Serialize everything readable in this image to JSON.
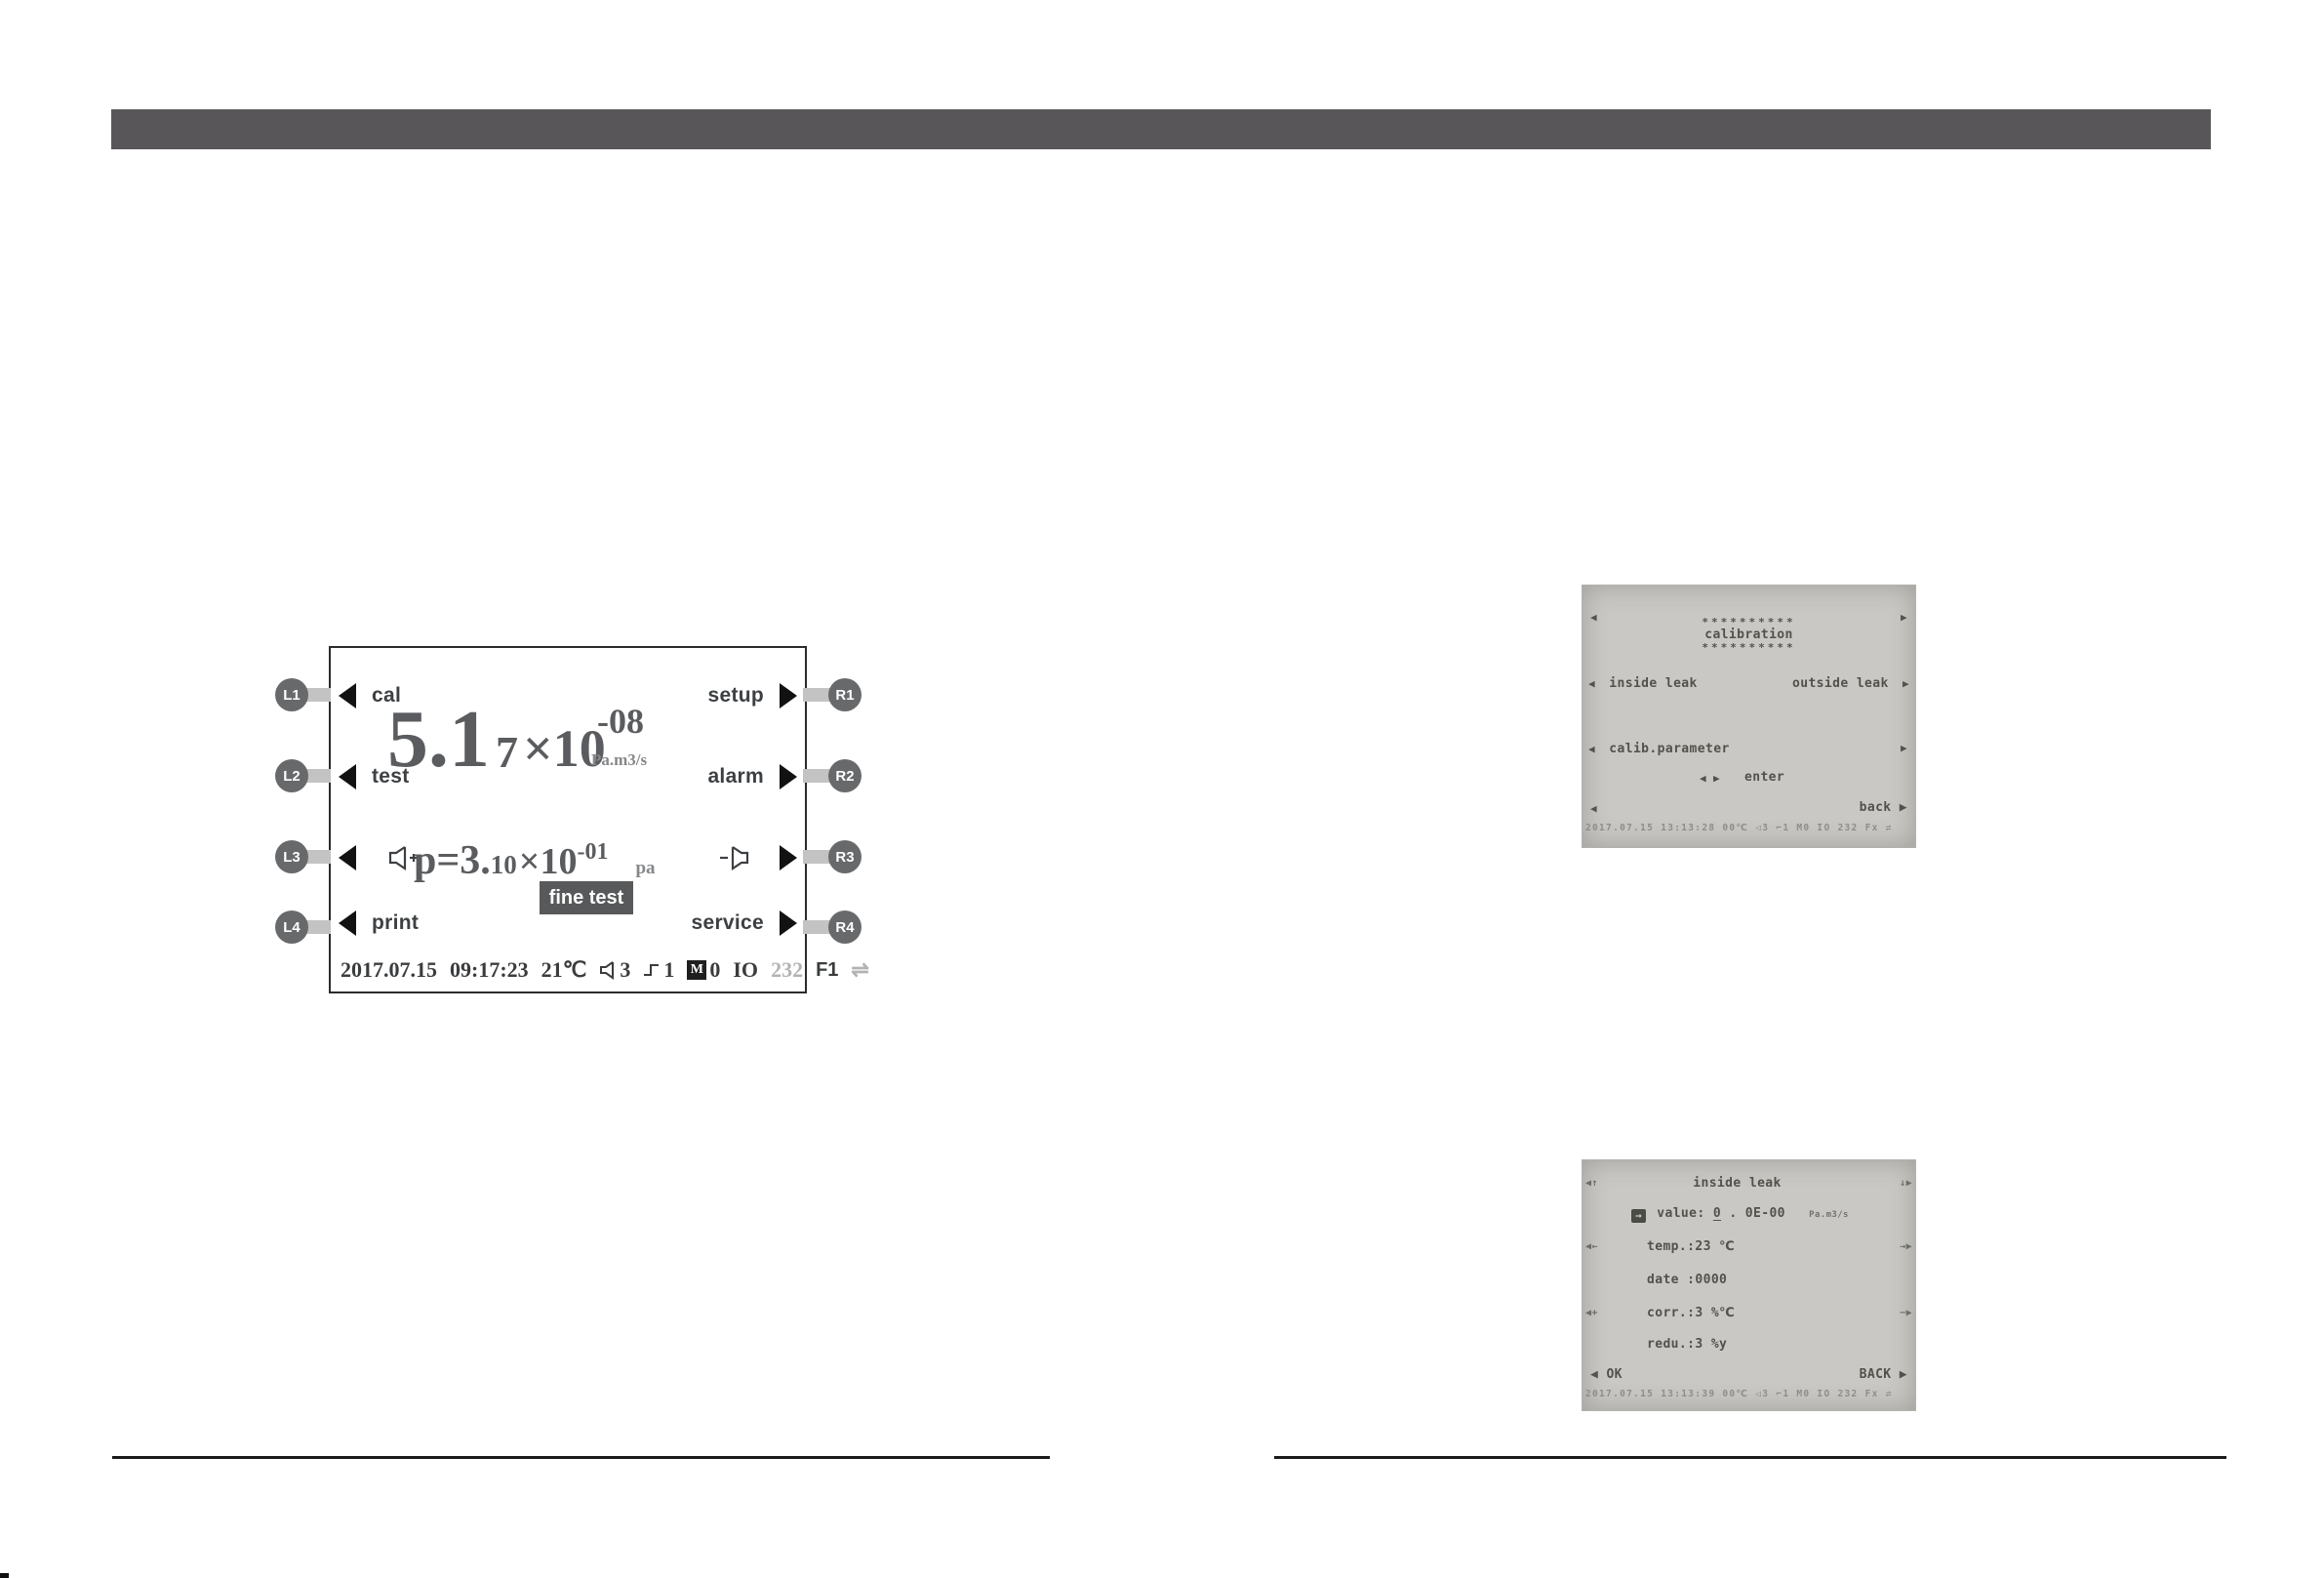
{
  "device_panel": {
    "left_buttons": [
      {
        "id": "L1",
        "label": "cal"
      },
      {
        "id": "L2",
        "label": "test"
      },
      {
        "id": "L3",
        "label": "",
        "icon": "volume-up-icon"
      },
      {
        "id": "L4",
        "label": "print"
      }
    ],
    "right_buttons": [
      {
        "id": "R1",
        "label": "setup"
      },
      {
        "id": "R2",
        "label": "alarm"
      },
      {
        "id": "R3",
        "label": "",
        "icon": "volume-down-icon"
      },
      {
        "id": "R4",
        "label": "service"
      }
    ],
    "leak_rate": {
      "mantissa": "5.1",
      "digit_small": "7",
      "times": "×10",
      "exponent": "-08",
      "unit": "Pa.m3/s"
    },
    "pressure": {
      "prefix": "p=3.",
      "digit_small": "10",
      "times": "×10",
      "exponent": "-01",
      "unit": "pa"
    },
    "mode_badge": "fine test",
    "status_bar": {
      "date": "2017.07.15",
      "time": "09:17:23",
      "temperature": "21℃",
      "volume_level": "3",
      "pulse_level": "1",
      "memory_letter": "M",
      "memory_value": "0",
      "io_label": "IO",
      "serial_label": "232",
      "function_label": "F1",
      "link_symbol": "⇌"
    }
  },
  "lcd_calibration": {
    "nav_left": "◀",
    "nav_right": "▶",
    "stars_top": "**********",
    "title": "calibration",
    "stars_bottom": "**********",
    "inside_leak_arrow": "◀",
    "inside_leak_label": "inside leak",
    "outside_leak_label": "outside leak",
    "outside_leak_arrow": "▶",
    "param_arrow": "◀",
    "param_label": "calib.parameter",
    "param_right_arrow": "▶",
    "enter_arrows": "◀ ▶",
    "enter_label": "enter",
    "back_left_arrow": "◀",
    "back_label": "back ▶",
    "status_line": "2017.07.15 13:13:28 00℃ ◁3 ⌐1 M0 IO 232 Fx ⇌"
  },
  "lcd_inside_leak": {
    "nav_top_left": "◀↑",
    "title": "inside leak",
    "nav_top_right": "↓▶",
    "value_cursor": "→",
    "value_label": "value:",
    "value_first": "0",
    "value_rest": ". 0E-00",
    "value_unit": "Pa.m3/s",
    "temp_nav_left": "◀←",
    "temp_label": "temp.:23 ℃",
    "temp_nav_right": "→▶",
    "date_label": "date :0000",
    "corr_nav_left": "◀+",
    "corr_label": "corr.:3 %℃",
    "corr_nav_right": "−▶",
    "redu_label": "redu.:3 %y",
    "ok_label": "◀ OK",
    "back_label": "BACK ▶",
    "status_line": "2017.07.15 13:13:39 00℃ ◁3 ⌐1 M0 IO 232 Fx ⇌"
  }
}
